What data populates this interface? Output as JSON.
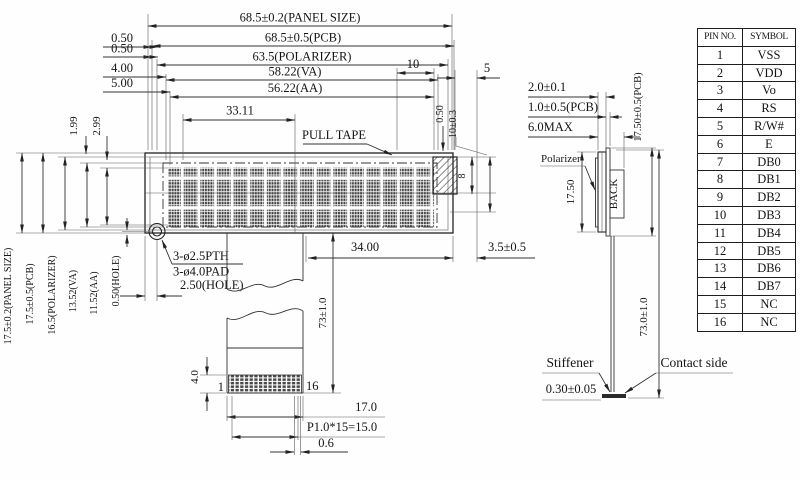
{
  "fv": {
    "panel_w": "68.5±0.2(PANEL SIZE)",
    "pcb_w": "68.5±0.5(PCB)",
    "pol_w": "63.5(POLARIZER)",
    "va_w": "58.22(VA)",
    "aa_w": "56.22(AA)",
    "d10": "10",
    "d5": "5",
    "d3311": "33.11",
    "off_a": "0.50",
    "off_b": "0.50",
    "off_c": "4.00",
    "off_d": "5.00",
    "v199": "1.99",
    "v299": "2.99",
    "panel_h": "17.5±0.2(PANEL SIZE)",
    "pcb_h": "17.5±0.5(PCB)",
    "pol_h": "16.5(POLARIZER)",
    "va_h": "13.52(VA)",
    "aa_h": "11.52(AA)",
    "hole_v": "0.50(HOLE)",
    "pull_tape": "PULL TAPE",
    "hole_pth": "3-ø2.5PTH",
    "hole_pad": "3-ø4.0PAD",
    "hole_x": "2.50(HOLE)",
    "r050": "0.50",
    "r10": "10±0.3",
    "r8": "8",
    "d34": "34.00",
    "d35": "3.5±0.5",
    "d73": "73±1.0",
    "d40": "4.0",
    "pin1": "1",
    "pin16": "16",
    "d17": "17.0",
    "pitch": "P1.0*15=15.0",
    "d06": "0.6"
  },
  "sv": {
    "d20": "2.0±0.1",
    "d10pcb": "1.0±0.5(PCB)",
    "d6max": "6.0MAX",
    "pol": "Polarizer",
    "d1750": "17.50",
    "back": "BACK",
    "d1750pcb": "17.50±0.5(PCB)",
    "d730": "73.0±1.0",
    "stiff": "Stiffener",
    "contact": "Contact side",
    "d030": "0.30±0.05"
  },
  "table": {
    "h1": "PIN NO.",
    "h2": "SYMBOL",
    "rows": [
      [
        "1",
        "VSS"
      ],
      [
        "2",
        "VDD"
      ],
      [
        "3",
        "Vo"
      ],
      [
        "4",
        "RS"
      ],
      [
        "5",
        "R/W#"
      ],
      [
        "6",
        "E"
      ],
      [
        "7",
        "DB0"
      ],
      [
        "8",
        "DB1"
      ],
      [
        "9",
        "DB2"
      ],
      [
        "10",
        "DB3"
      ],
      [
        "11",
        "DB4"
      ],
      [
        "12",
        "DB5"
      ],
      [
        "13",
        "DB6"
      ],
      [
        "14",
        "DB7"
      ],
      [
        "15",
        "NC"
      ],
      [
        "16",
        "NC"
      ]
    ]
  }
}
